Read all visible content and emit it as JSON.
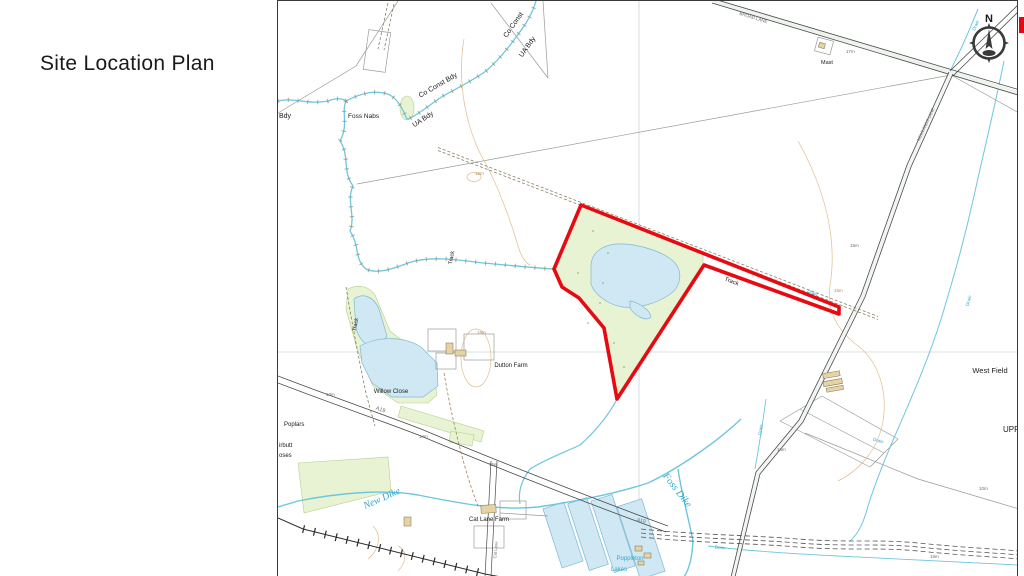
{
  "title": "Site Location Plan",
  "north": {
    "label": "N"
  },
  "colors": {
    "site_boundary": "#e60b12",
    "legend_red": "#e30613",
    "water_line": "#6ec6dd",
    "water_fill": "#cfe8f4",
    "vegetation": "#e7f3d3",
    "contour": "#cfa36c",
    "label_black": "#1a1a1a",
    "label_blue": "#2fa8cd",
    "label_tan": "#b9894e",
    "label_grey": "#6e6e6e"
  },
  "map": {
    "labels": [
      {
        "n": "bdy-cutoff-label",
        "t": "Bdy",
        "x": 1,
        "y": 117,
        "s": 7
      },
      {
        "n": "foss-nabs-label",
        "t": "Foss Nabs",
        "x": 70,
        "y": 117,
        "s": 6.5
      },
      {
        "n": "co-const-bdy-label-1",
        "t": "Co Const Bdy",
        "x": 161,
        "y": 86,
        "r": -30,
        "s": 7,
        "a": "m"
      },
      {
        "n": "ua-bdy-label-1",
        "t": "UA Bdy",
        "x": 146,
        "y": 120,
        "r": -33,
        "s": 7,
        "a": "m"
      },
      {
        "n": "co-const-label-2",
        "t": "Co Const",
        "x": 237,
        "y": 25,
        "r": -55,
        "s": 7,
        "a": "m"
      },
      {
        "n": "ua-bdy-label-2",
        "t": "UA Bdy",
        "x": 251,
        "y": 47,
        "r": -55,
        "s": 7,
        "a": "m"
      },
      {
        "n": "broad-lane-label",
        "t": "BROAD LANE",
        "x": 475,
        "y": 18,
        "r": 17,
        "s": 4.5,
        "c": "g",
        "a": "m"
      },
      {
        "n": "mast-label",
        "t": "Mast",
        "x": 543,
        "y": 63,
        "s": 5.5
      },
      {
        "n": "spot-height-17m",
        "t": "17m",
        "x": 568,
        "y": 52,
        "s": 4.5,
        "c": "g"
      },
      {
        "n": "ne-road-name-label",
        "t": "NEWLANDS LANE",
        "x": 649,
        "y": 124,
        "r": -65,
        "s": 4.2,
        "c": "g",
        "a": "m"
      },
      {
        "n": "drain-label-1",
        "t": "Drain",
        "x": 699,
        "y": 25,
        "r": -66,
        "s": 4.5,
        "c": "b",
        "a": "m"
      },
      {
        "n": "track-label-1",
        "t": "Track",
        "x": 175,
        "y": 257,
        "r": -80,
        "s": 5.5,
        "a": "m"
      },
      {
        "n": "track-label-2",
        "t": "Track",
        "x": 453,
        "y": 282,
        "r": 21,
        "s": 6,
        "a": "m"
      },
      {
        "n": "spot-height-15m-a",
        "t": "15m",
        "x": 572,
        "y": 246,
        "s": 4.5,
        "c": "g"
      },
      {
        "n": "contour-label-15m-b",
        "t": "15m",
        "x": 556,
        "y": 291,
        "s": 4.5,
        "c": "t"
      },
      {
        "n": "drain-label-2",
        "t": "Drain",
        "x": 534,
        "y": 293,
        "r": 21,
        "s": 4.5,
        "c": "b",
        "a": "m"
      },
      {
        "n": "drain-label-3",
        "t": "Drain",
        "x": 692,
        "y": 300,
        "r": -75,
        "s": 4.5,
        "c": "b",
        "a": "m"
      },
      {
        "n": "west-field-label",
        "t": "West Field",
        "x": 712,
        "y": 372,
        "s": 7.5,
        "a": "m"
      },
      {
        "n": "contour-label-16m-a",
        "t": "16m",
        "x": 197,
        "y": 174,
        "s": 4.5,
        "c": "t"
      },
      {
        "n": "contour-label-15m-c",
        "t": "15m",
        "x": 199,
        "y": 333,
        "s": 4.5,
        "c": "t"
      },
      {
        "n": "dutton-farm-label",
        "t": "Dutton Farm",
        "x": 233,
        "y": 366,
        "s": 6,
        "a": "m"
      },
      {
        "n": "track-label-3",
        "t": "Track",
        "x": 79,
        "y": 324,
        "r": -80,
        "s": 5.5,
        "a": "m"
      },
      {
        "n": "willow-close-label",
        "t": "Willow Close",
        "x": 113,
        "y": 392,
        "s": 6,
        "a": "m"
      },
      {
        "n": "poplars-label",
        "t": "Poplars",
        "x": 6,
        "y": 425,
        "s": 6
      },
      {
        "n": "cutoff-label-1",
        "t": "irbutt",
        "x": 1,
        "y": 446,
        "s": 6
      },
      {
        "n": "cutoff-label-2",
        "t": "oses",
        "x": 1,
        "y": 456,
        "s": 6
      },
      {
        "n": "spot-height-10m-a",
        "t": "10m",
        "x": 48,
        "y": 395,
        "s": 4.5,
        "c": "g"
      },
      {
        "n": "a19-road-label-1",
        "t": "A19",
        "x": 102,
        "y": 410,
        "r": 20,
        "s": 5.5,
        "c": "g",
        "a": "m"
      },
      {
        "n": "spot-height-14m",
        "t": "14m",
        "x": 141,
        "y": 437,
        "s": 4.5,
        "c": "g"
      },
      {
        "n": "spot-height-15m-d",
        "t": "15m",
        "x": 211,
        "y": 465,
        "s": 4.5,
        "c": "g"
      },
      {
        "n": "new-dike-label",
        "t": "New Dike",
        "x": 105,
        "y": 500,
        "r": -24,
        "s": 10,
        "c": "b",
        "i": 1,
        "a": "m"
      },
      {
        "n": "foss-dike-label",
        "t": "Foss Dike",
        "x": 397,
        "y": 491,
        "r": 52,
        "s": 10,
        "c": "b",
        "i": 1,
        "a": "m"
      },
      {
        "n": "cat-lane-farm-label",
        "t": "Cat Lane Farm",
        "x": 211,
        "y": 520,
        "s": 6,
        "a": "m"
      },
      {
        "n": "cat-lane-label",
        "t": "Cat Lane",
        "x": 219,
        "y": 549,
        "r": -85,
        "s": 4.2,
        "c": "g",
        "a": "m"
      },
      {
        "n": "a19-road-label-2",
        "t": "A19",
        "x": 363,
        "y": 521,
        "r": 12,
        "s": 5,
        "c": "g",
        "a": "m"
      },
      {
        "n": "drain-label-4",
        "t": "Drain",
        "x": 600,
        "y": 441,
        "r": 15,
        "s": 4.5,
        "c": "b",
        "a": "m"
      },
      {
        "n": "drain-label-5",
        "t": "Drain",
        "x": 484,
        "y": 429,
        "r": -80,
        "s": 4.5,
        "c": "b",
        "a": "m"
      },
      {
        "n": "drain-label-6",
        "t": "Drain",
        "x": 442,
        "y": 548,
        "r": 4,
        "s": 4.5,
        "c": "b",
        "a": "m"
      },
      {
        "n": "spot-height-16m-b",
        "t": "16m",
        "x": 499,
        "y": 450,
        "s": 4.5,
        "c": "g"
      },
      {
        "n": "spot-height-10m-b",
        "t": "10m",
        "x": 701,
        "y": 489,
        "s": 4.5,
        "c": "g"
      },
      {
        "n": "spot-height-15m-f",
        "t": "15m",
        "x": 652,
        "y": 557,
        "s": 4.5,
        "c": "g"
      },
      {
        "n": "upper-poppleton-cutoff-label",
        "t": "UPP",
        "x": 725,
        "y": 431,
        "s": 8
      },
      {
        "n": "poppleton-lakes-label-1",
        "t": "Poppleton",
        "x": 352,
        "y": 559,
        "s": 6,
        "c": "b",
        "a": "m"
      },
      {
        "n": "poppleton-lakes-label-2",
        "t": "Lakes",
        "x": 341,
        "y": 570,
        "s": 6,
        "c": "b",
        "a": "m"
      }
    ]
  }
}
